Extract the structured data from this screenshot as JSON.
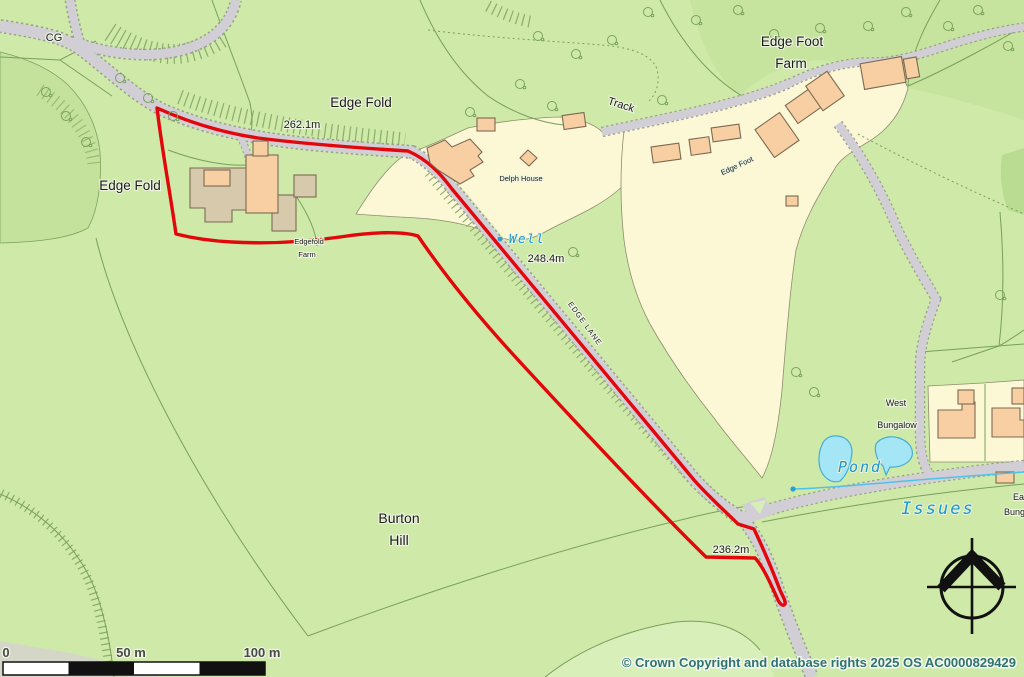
{
  "map": {
    "labels": {
      "cg": "CG",
      "edge_fold_top": "Edge Fold",
      "edge_fold_left": "Edge Fold",
      "delph_house": "Delph House",
      "well": "Well",
      "edgefold_farm": [
        "Edgefold",
        "Farm"
      ],
      "edge_lane": "EDGE LANE",
      "track": "Track",
      "edge_foot_farm": [
        "Edge Foot",
        "Farm"
      ],
      "edge_foot": "Edge Foot",
      "west_bungalow": [
        "West",
        "Bungalow"
      ],
      "east_bungalow": [
        "East",
        "Bungalow"
      ],
      "pond": "Pond",
      "issues": "Issues",
      "burton_hill": [
        "Burton",
        "Hill"
      ]
    },
    "spot_heights": {
      "edge_fold": "262.1m",
      "edge_lane": "248.4m",
      "junction": "236.2m"
    },
    "scale_bar": {
      "t0": "0",
      "t50": "50 m",
      "t100": "100 m"
    },
    "copyright": "© Crown Copyright and database rights 2025 OS AC0000829429",
    "colors": {
      "boundary_red": "#e2070b",
      "water_fill": "#a5e6f6",
      "water_text": "#1e96d2",
      "copyright_teal": "#2f7373",
      "road_gray": "#d1ced5",
      "field_green": "#cfe9a8",
      "plot_cream": "#fcf8d5",
      "building_tan": "#f8cfa2"
    }
  }
}
